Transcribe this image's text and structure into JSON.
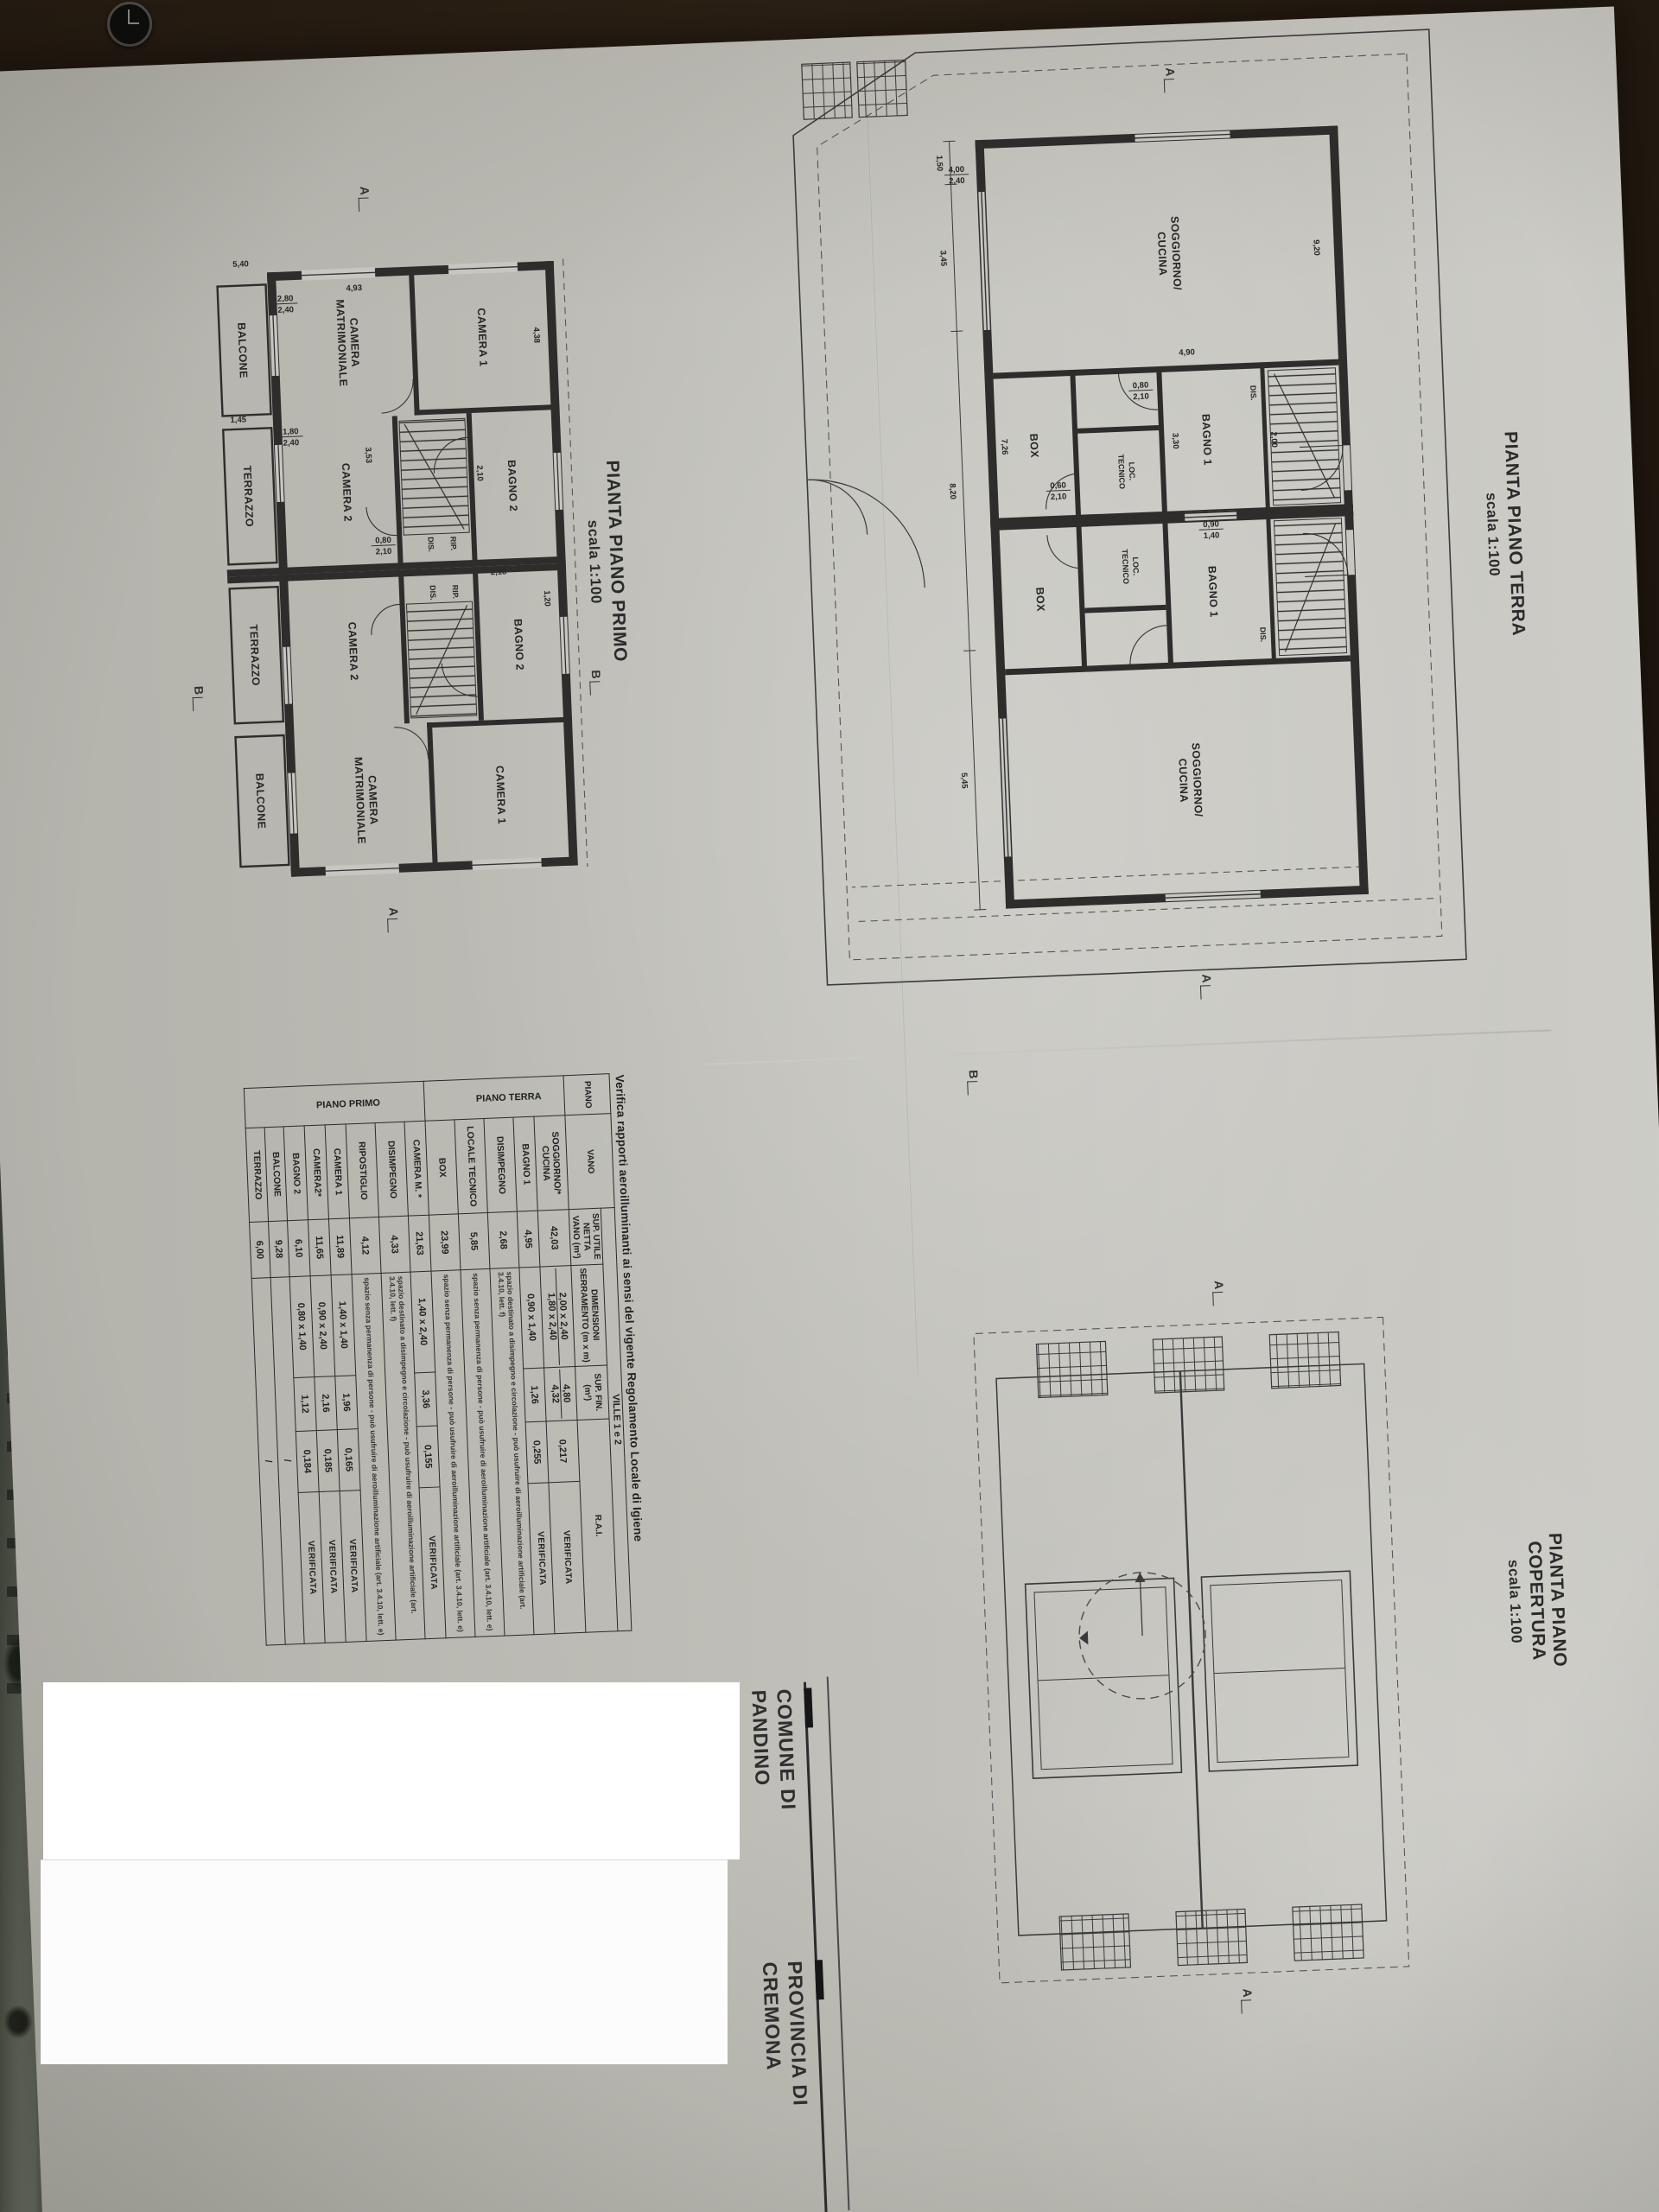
{
  "sheet": {
    "plan_primo": {
      "title": "PIANTA PIANO PRIMO",
      "scale": "scala 1:100"
    },
    "plan_terra": {
      "title": "PIANTA PIANO TERRA",
      "scale": "scala 1:100"
    },
    "plan_copertura": {
      "title": "PIANTA PIANO COPERTURA",
      "scale": "scala 1:100"
    },
    "title_block": {
      "comune_line1": "COMUNE DI",
      "comune_line2": "PANDINO",
      "provincia_line1": "PROVINCIA DI",
      "provincia_line2": "CREMONA"
    },
    "section_marks": {
      "a": "A",
      "b": "B"
    }
  },
  "verifica_table": {
    "title": "Verifica rapporti aeroilluminanti ai sensi del vigente Regolamento Locale di Igiene",
    "span_header": "VILLE 1 e 2",
    "col_piano": "PIANO",
    "col_vano": "VANO",
    "col_sup": "SUP. UTILE NETTA VANO (m²)",
    "col_dim": "DIMENSIONI SERRAMENTO (m x m)",
    "col_fin": "SUP. FIN. (m²)",
    "col_rai": "R.A.I.",
    "group_terra": "PIANO TERRA",
    "group_primo": "PIANO PRIMO",
    "rows": [
      {
        "vano": "SOGGIORNO/*",
        "vano2": "CUCINA",
        "sup": "42,03",
        "dim": "2,00 x 2,40",
        "dim2": "1,80 x 2,40",
        "fin": "4,80",
        "fin2": "4,32",
        "rai": "0,217",
        "verdict": "VERIFICATA"
      },
      {
        "vano": "BAGNO 1",
        "sup": "4,95",
        "dim": "0,90 x 1,40",
        "fin": "1,26",
        "rai": "0,255",
        "verdict": "VERIFICATA"
      },
      {
        "vano": "DISIMPEGNO",
        "sup": "2,68",
        "note": "spazio destinato a disimpegno e circolazione - può usufruire di aeroilluminazione artificiale (art. 3.4.10, lett. f)"
      },
      {
        "vano": "LOCALE TECNICO",
        "sup": "5,85",
        "note": "spazio senza permanenza di persone - può usufruire di aeroilluminazione artificiale (art. 3.4.10, lett. e)"
      },
      {
        "vano": "BOX",
        "sup": "23,99",
        "note": "spazio senza permanenza di persone - può usufruire di aeroilluminazione artificiale (art. 3.4.10, lett. e)"
      },
      {
        "vano": "CAMERA M. *",
        "sup": "21,63",
        "dim": "1,40 x 2,40",
        "fin": "3,36",
        "rai": "0,155",
        "verdict": "VERIFICATA"
      },
      {
        "vano": "DISIMPEGNO",
        "sup": "4,33",
        "note": "spazio destinato a disimpegno e circolazione - può usufruire di aeroilluminazione artificiale (art. 3.4.10, lett. f)"
      },
      {
        "vano": "RIPOSTIGLIO",
        "sup": "4,12",
        "note": "spazio senza permanenza di persone - può usufruire di aeroilluminazione artificiale (art. 3.4.10, lett. e)"
      },
      {
        "vano": "CAMERA 1",
        "sup": "11,89",
        "dim": "1,40 x 1,40",
        "fin": "1,96",
        "rai": "0,165",
        "verdict": "VERIFICATA"
      },
      {
        "vano": "CAMERA2*",
        "sup": "11,65",
        "dim": "0,90 x 2,40",
        "fin": "2,16",
        "rai": "0,185",
        "verdict": "VERIFICATA"
      },
      {
        "vano": "BAGNO 2",
        "sup": "6,10",
        "dim": "0,80 x 1,40",
        "fin": "1,12",
        "rai": "0,184",
        "verdict": "VERIFICATA"
      },
      {
        "vano": "BALCONE",
        "sup": "9,28",
        "slash": "/"
      },
      {
        "vano": "TERRAZZO",
        "sup": "6,00",
        "slash": "/"
      }
    ]
  },
  "plans": {
    "primo": {
      "rooms": {
        "camera1": "CAMERA 1",
        "bagno2": "BAGNO 2",
        "dis": "DIS.",
        "rip": "RIP.",
        "camera_a": "CAMERA",
        "camera_b": "MATRIMONIALE",
        "camera2": "CAMERA 2",
        "balcone": "BALCONE",
        "terrazzo": "TERRAZZO"
      },
      "dims": [
        "4,38",
        "4,93",
        "2,80",
        "2,40",
        "5,40",
        "1,45",
        "3,53",
        "1,80",
        "2,40",
        "0,80",
        "2,10",
        "2,10",
        "2,18",
        "1,20"
      ]
    },
    "terra": {
      "rooms": {
        "sogg_a": "SOGGIORNO/",
        "sogg_b": "CUCINA",
        "dis": "DIS.",
        "bagno1": "BAGNO 1",
        "loc_a": "LOC.",
        "loc_b": "TECNICO",
        "box": "BOX"
      },
      "dims": [
        "9,20",
        "4,90",
        "4,00",
        "2,40",
        "3,30",
        "0,90",
        "1,40",
        "0,80",
        "2,10",
        "0,60",
        "2,10",
        "2,00",
        "7,26",
        "1,50",
        "3,45",
        "8,20",
        "5,45"
      ]
    }
  }
}
